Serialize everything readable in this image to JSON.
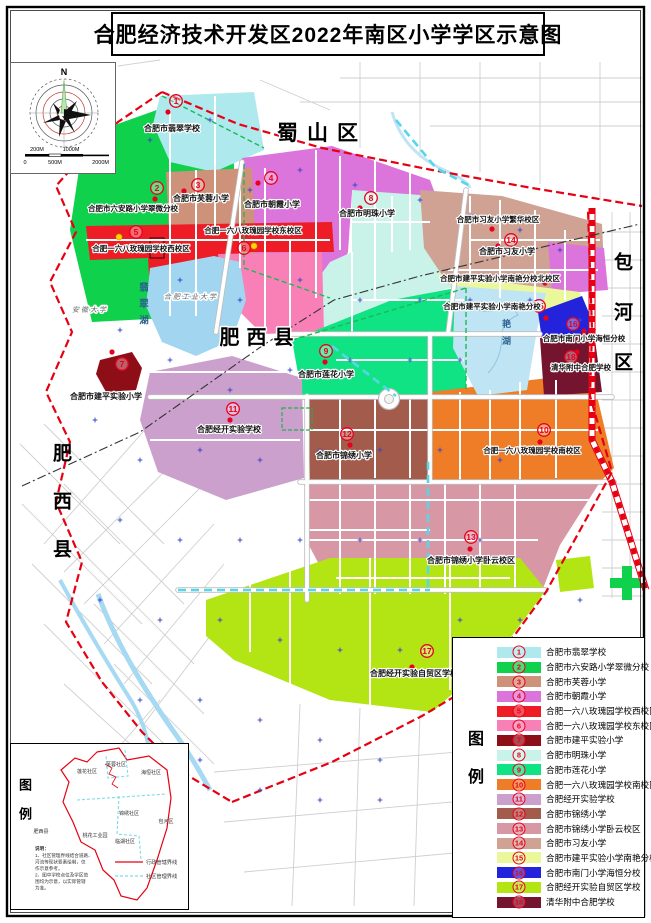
{
  "title": "合肥经济技术开发区2022年南区小学学区示意图",
  "compass": {
    "north": "N"
  },
  "scalebar": {
    "top": [
      "200M",
      "1000M"
    ],
    "bottom": [
      "0",
      "500M",
      "2000M"
    ]
  },
  "districts": {
    "shushan": "蜀山区",
    "feixi": "肥西县",
    "baohe": "包河区"
  },
  "landmarks": {
    "anhui_university": "安徽大学",
    "hfut": "合肥工业大学",
    "feicui_lake": "翡翠湖",
    "nanyan_lake": "艳湖"
  },
  "legend": {
    "header": "图例",
    "items": [
      {
        "num": "1",
        "name": "合肥市翡翠学校",
        "color": "#ADE9ED"
      },
      {
        "num": "2",
        "name": "合肥市六安路小学翠微分校",
        "color": "#0FD14B"
      },
      {
        "num": "3",
        "name": "合肥市芙蓉小学",
        "color": "#CE9179"
      },
      {
        "num": "4",
        "name": "合肥市朝霞小学",
        "color": "#DB74DB"
      },
      {
        "num": "5",
        "name": "合肥一六八玫瑰园学校西校区",
        "color": "#EE1C25"
      },
      {
        "num": "6",
        "name": "合肥一六八玫瑰园学校东校区",
        "color": "#F980B6"
      },
      {
        "num": "7",
        "name": "合肥市建平实验小学",
        "color": "#8E0E18"
      },
      {
        "num": "8",
        "name": "合肥市明珠小学",
        "color": "#C9F3E9"
      },
      {
        "num": "9",
        "name": "合肥市莲花小学",
        "color": "#10E383"
      },
      {
        "num": "10",
        "name": "合肥一六八玫瑰园学校南校区",
        "color": "#EF7D27"
      },
      {
        "num": "11",
        "name": "合肥经开实验学校",
        "color": "#CBA0CD"
      },
      {
        "num": "12",
        "name": "合肥市锦绣小学",
        "color": "#A35B4C"
      },
      {
        "num": "13",
        "name": "合肥市锦绣小学卧云校区",
        "color": "#D897A4"
      },
      {
        "num": "14",
        "name": "合肥市习友小学",
        "color": "#CFA294"
      },
      {
        "num": "15",
        "name": "合肥市建平实验小学南艳分校",
        "color": "#EAF79A"
      },
      {
        "num": "16",
        "name": "合肥市南门小学海恒分校",
        "color": "#2323DB"
      },
      {
        "num": "17",
        "name": "合肥经开实验自贸区学校",
        "color": "#B3E514"
      },
      {
        "num": "18",
        "name": "清华附中合肥学校",
        "color": "#75142F"
      }
    ]
  },
  "map_extra": {
    "xiyou_fanhua": "合肥市习友小学繁华校区",
    "jianping_north": "合肥市建平实验小学南艳分校北校区"
  },
  "inset": {
    "header": "图例",
    "communities": [
      "莲花社区",
      "芙蓉社区",
      "海恒社区",
      "锦绣社区",
      "临湖社区",
      "桃花工业园"
    ],
    "neighbors": [
      "肥西县",
      "包河区"
    ],
    "notes_title": "说明：",
    "notes": [
      "1、社区管理界线结合道路、",
      "河流等现状要素绘制，仅",
      "作示意参考。",
      "2、图中学校点位及学区范",
      "围均为示意，以实际管辖",
      "为准。"
    ],
    "line_legend": [
      {
        "label": "行政管辖界线"
      },
      {
        "label": "社区管理界线"
      }
    ]
  }
}
